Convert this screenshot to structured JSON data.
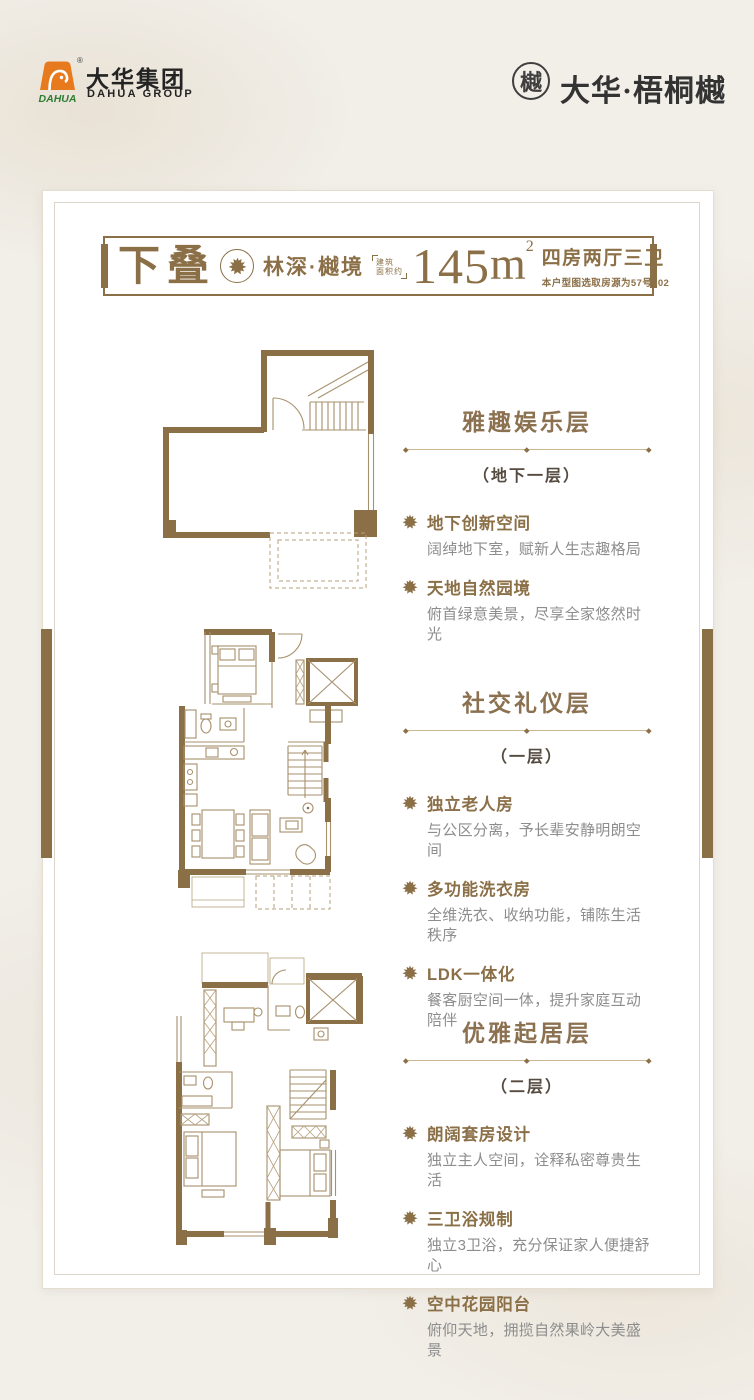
{
  "header": {
    "dahua_logo": {
      "cn": "大华集团",
      "en": "DAHUA GROUP",
      "mark_text": "DAHUA",
      "registered": "®"
    },
    "project_logo": {
      "seal_char": "樾",
      "name": "大华·梧桐樾"
    }
  },
  "banner": {
    "unit_type": "下叠",
    "series": "林深·樾境",
    "area_prefix_line1": "建筑",
    "area_prefix_line2": "面积约",
    "area_value": "145",
    "area_unit": "m",
    "area_exponent": "2",
    "rooms": "四房两厅三卫",
    "source_note": "本户型图选取房源为57号102"
  },
  "sections": [
    {
      "title": "雅趣娱乐层",
      "subtitle": "（地下一层）",
      "bullets": [
        {
          "title": "地下创新空间",
          "desc": "阔绰地下室，赋新人生志趣格局"
        },
        {
          "title": "天地自然园境",
          "desc": "俯首绿意美景，尽享全家悠然时光"
        }
      ]
    },
    {
      "title": "社交礼仪层",
      "subtitle": "（一层）",
      "bullets": [
        {
          "title": "独立老人房",
          "desc": "与公区分离，予长辈安静明朗空间"
        },
        {
          "title": "多功能洗衣房",
          "desc": "全维洗衣、收纳功能，铺陈生活秩序"
        },
        {
          "title": "LDK一体化",
          "desc": "餐客厨空间一体，提升家庭互动陪伴"
        }
      ]
    },
    {
      "title": "优雅起居层",
      "subtitle": "（二层）",
      "bullets": [
        {
          "title": "朗阔套房设计",
          "desc": "独立主人空间，诠释私密尊贵生活"
        },
        {
          "title": "三卫浴规制",
          "desc": "独立3卫浴，充分保证家人便捷舒心"
        },
        {
          "title": "空中花园阳台",
          "desc": "俯仰天地，拥揽自然果岭大美盛景"
        }
      ]
    }
  ],
  "colors": {
    "accent_brown": "#8b6f47",
    "divider_tan": "#ccb890",
    "subtitle_dark": "#554b40",
    "desc_gray": "#8d8d8d",
    "logo_orange": "#e87a1e",
    "logo_green": "#2f7d32",
    "logo_dark": "#3f3f3f"
  }
}
